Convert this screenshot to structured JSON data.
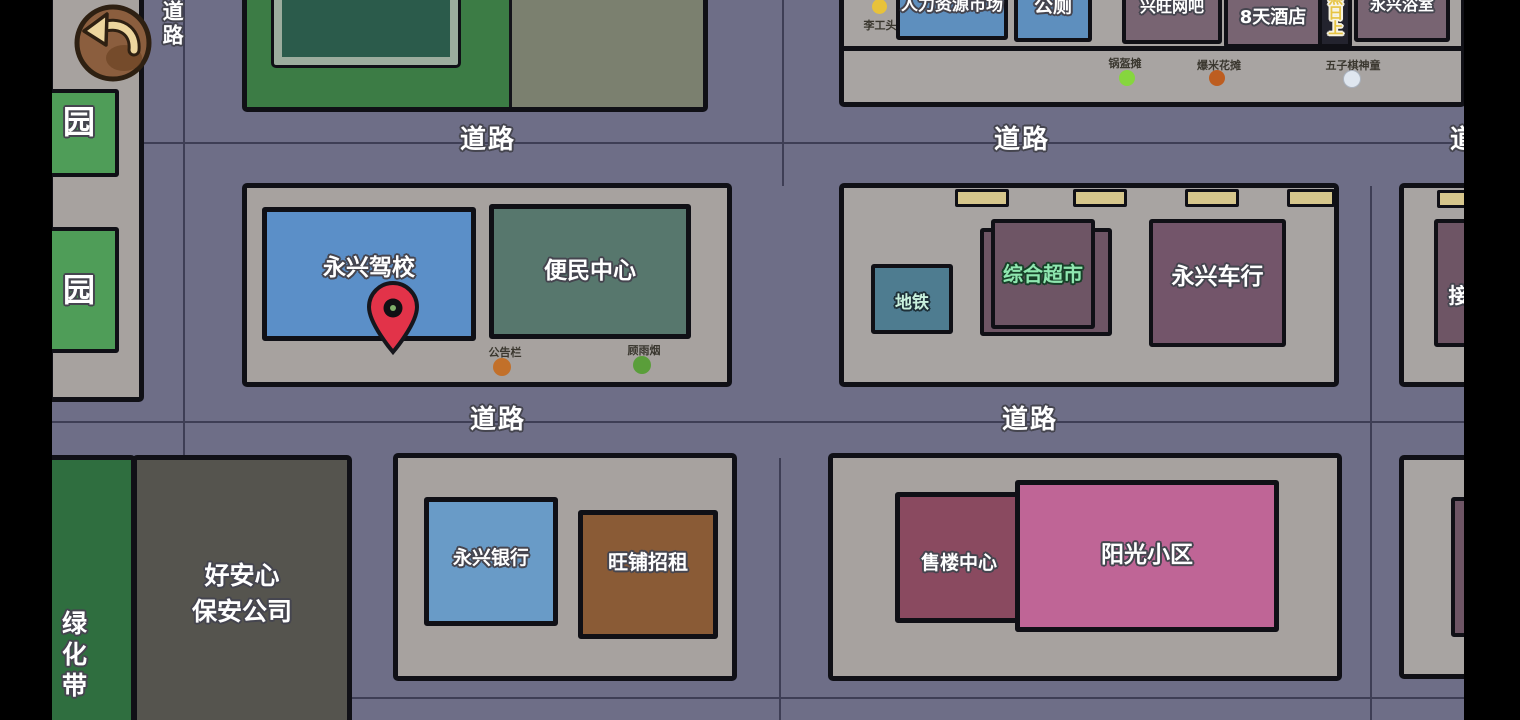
{
  "toolbar": {
    "back_icon": "curved-left-arrow"
  },
  "labels": {
    "road": "道路"
  },
  "left_strip": {
    "partial_building_char": "园"
  },
  "top_mid_block": {
    "framed_building": ""
  },
  "top_right_strip": {
    "buildings": [
      {
        "label": "人力资源市场"
      },
      {
        "label": "公厕"
      },
      {
        "label": "兴旺网吧"
      },
      {
        "label": "8天酒店"
      },
      {
        "label": "蒸日上"
      },
      {
        "label": "永兴浴室"
      }
    ],
    "stalls": [
      {
        "label": "李工头",
        "dot_color": "#E8C23A"
      },
      {
        "label": "锅盔摊",
        "dot_color": "#86D63E"
      },
      {
        "label": "爆米花摊",
        "dot_color": "#BD5D20"
      },
      {
        "label": "五子棋神童",
        "dot_color": "#DFE6EF"
      }
    ]
  },
  "mid_left_block": {
    "driving_school": "永兴驾校",
    "convenience_center": "便民中心",
    "markers": [
      {
        "label": "公告栏",
        "dot_color": "#C2702A"
      },
      {
        "label": "顾雨烟",
        "dot_color": "#5A9E3A"
      }
    ],
    "pin_color": "#E23349"
  },
  "mid_right_block": {
    "subway": "地铁",
    "supermarket": "综合超市",
    "car_dealer": "永兴车行",
    "clipped_building": "接"
  },
  "bottom_left_block": {
    "green_belt": "绿化带",
    "security_company_line1": "好安心",
    "security_company_line2": "保安公司"
  },
  "bottom_mid_block": {
    "bank": "永兴银行",
    "shop_for_rent": "旺铺招租"
  },
  "bottom_right_block": {
    "sales_center": "售楼中心",
    "residential": "阳光小区"
  },
  "palette": {
    "road": "#6E6E87",
    "sidewalk": "#A7A29F",
    "blue_building": "#5B8FC8",
    "teal_building": "#57776D",
    "maroon_building": "#6E5565",
    "pink_building": "#BF6596",
    "brown_building": "#8A5B36",
    "green_belt": "#2F6E3F",
    "pin": "#E23349"
  }
}
